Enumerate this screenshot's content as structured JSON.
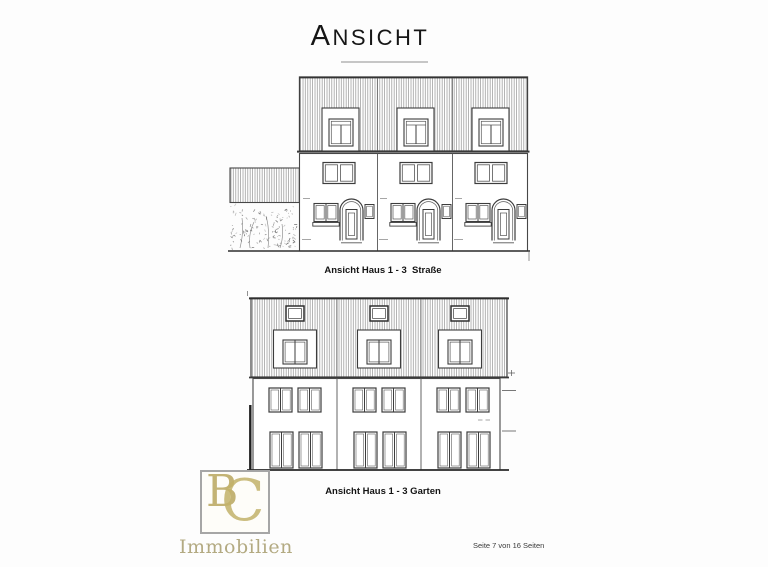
{
  "page": {
    "title": "ANSICHT",
    "footer": "Seite 7 von 16 Seiten",
    "background": "#fdfdfd"
  },
  "drawings": [
    {
      "name": "street-elevation",
      "caption": "Ansicht Haus 1 - 3  Straße",
      "houses": 3
    },
    {
      "name": "garden-elevation",
      "caption": "Ansicht Haus 1 - 3 Garten",
      "houses": 3
    }
  ],
  "logo": {
    "monogram_b": "B",
    "monogram_c": "C",
    "wordmark": "Immobilien",
    "gold": "#bfae68",
    "frame": "#a6a6a6"
  },
  "ink": {
    "line": "#3d3d3d",
    "hatch": "#8c8c8c",
    "ground": "#2f2f2f"
  }
}
